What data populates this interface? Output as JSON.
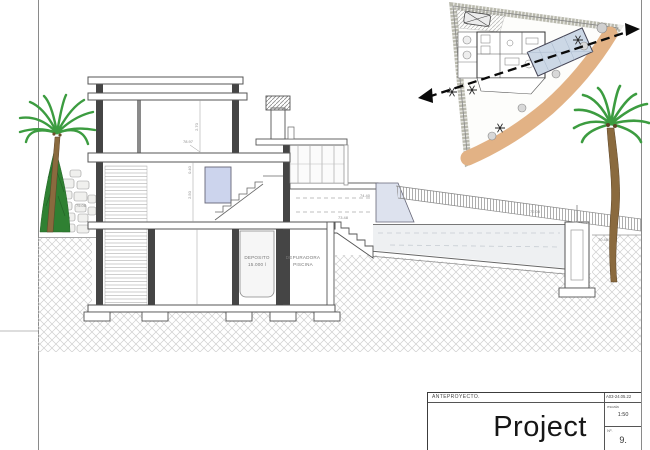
{
  "title_block": {
    "phase": "ANTEPROYECTO.",
    "doc_code": "A03-24.05.22",
    "scale_label": "escala",
    "scale_value": "1:50",
    "number_label": "Nº.",
    "sheet_number": "9.",
    "project_title": "Project"
  },
  "section": {
    "room_labels": [
      {
        "line1": "DEPOSITO",
        "line2": "15.000 l"
      },
      {
        "line1": "DEPURADORA",
        "line2": "PISCINA"
      }
    ],
    "dimensions": {
      "upper_floor_height": "2.70",
      "slab_thickness": "0.40",
      "ground_floor_height": "2.50"
    },
    "levels": {
      "left_upper": "75.06",
      "left_lower": "73.40",
      "roof": "78.97",
      "terrace": "74.40",
      "stairs_top": "73.48",
      "pool_wall": "72.08",
      "terrain_right": "70.48"
    }
  },
  "colors": {
    "tan_path": "#e2b285",
    "pool_water": "#ccd8e6",
    "window_glass": "#ccd4ed",
    "palm_green": "#3c9c40",
    "ground_hatch": "#cfcfcf",
    "line_gray": "#555555"
  }
}
